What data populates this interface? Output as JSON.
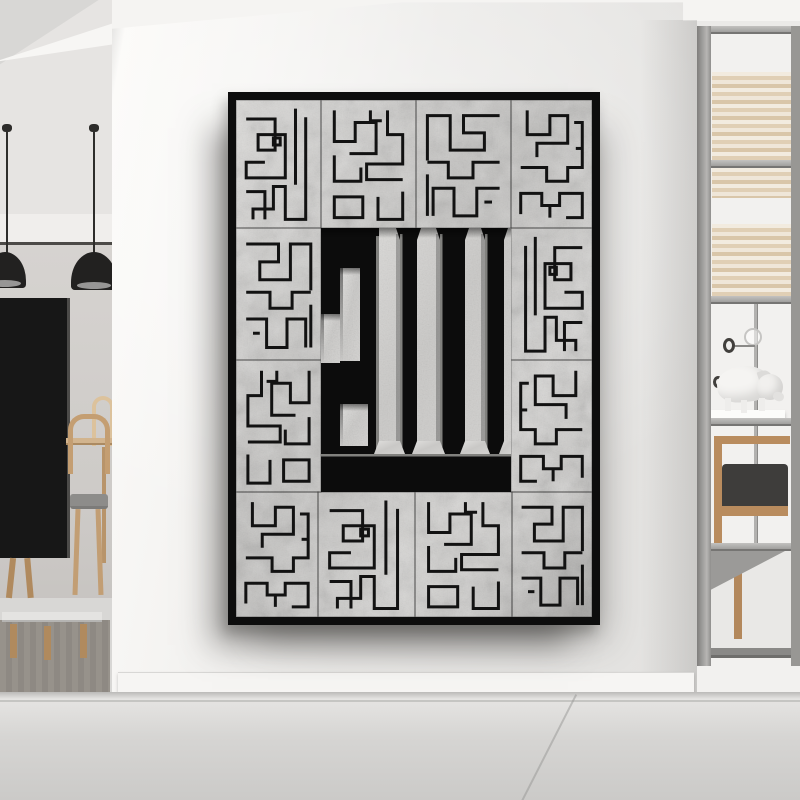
{
  "scene": {
    "subject": "Framed square Kufic calligraphy canvas hanging on a white wall in a modern minimalist interior",
    "rooms": {
      "left": [
        "pendant lamps",
        "tv panel",
        "dining table and chairs",
        "bench on rug"
      ],
      "right": [
        "metal shelving unit",
        "pig figurine",
        "lounge chair",
        "coat pole"
      ]
    }
  },
  "colors": {
    "wall_bright": "#fbfaf8",
    "wall_mid": "#ebeae8",
    "wall_shaded": "#e2e1df",
    "ceiling": "#f5f4f2",
    "room_upper_wall": "#e6e4e2",
    "room_band": "#f0eeec",
    "room_trim": "#4c4a47",
    "room_floor": "#d8d7d5",
    "rug": "#96918a",
    "lamp_black": "#222120",
    "lamp_rim": "#979695",
    "cord": "#2e2d2b",
    "tv_black": "#171717",
    "wood": "#c49e72",
    "wood_light": "#dcc29c",
    "wood_dark": "#b08a5e",
    "seat_gray": "#8d8c8a",
    "shelf_plate": "#a09f9d",
    "shelf_plate_light": "#c3c2c0",
    "shelf_back": "#f2f1ef",
    "slat_light": "#f2ebdf",
    "slat_dark": "#e0cfb5",
    "pole_gray": "#b2b1af",
    "pig_white": "#f5f4f2",
    "pig_shade": "#d8d7d5",
    "cushion_dark": "#3e3d3b",
    "chair_wood": "#b98c5e",
    "floor_light": "#e5e4e2",
    "floor_dark": "#cbcac8",
    "baseboard": "#f6f5f3",
    "frame_black": "#0d0d0d",
    "marble_light": "#d9d8d6",
    "marble_dark": "#bcbbb9",
    "ink": "#0c0c0c"
  },
  "artwork": {
    "word": "الله",
    "style": "square-kufic",
    "frame": {
      "x": 228,
      "y": 92,
      "w": 372,
      "h": 533,
      "border": 8
    },
    "inner": {
      "w": 356,
      "h": 517
    },
    "tiles": [
      {
        "x": 0,
        "y": 0,
        "w": 85,
        "h": 128,
        "p": "a"
      },
      {
        "x": 85,
        "y": 0,
        "w": 95,
        "h": 128,
        "p": "b"
      },
      {
        "x": 180,
        "y": 0,
        "w": 95,
        "h": 128,
        "p": "c",
        "fx": 1
      },
      {
        "x": 275,
        "y": 0,
        "w": 81,
        "h": 128,
        "p": "d"
      },
      {
        "x": 0,
        "y": 128,
        "w": 85,
        "h": 132,
        "p": "c"
      },
      {
        "x": 0,
        "y": 260,
        "w": 85,
        "h": 132,
        "p": "b",
        "fx": 1
      },
      {
        "x": 275,
        "y": 128,
        "w": 81,
        "h": 132,
        "p": "a",
        "fx": 1
      },
      {
        "x": 275,
        "y": 260,
        "w": 81,
        "h": 132,
        "p": "d",
        "fx": 1
      },
      {
        "x": 0,
        "y": 392,
        "w": 82,
        "h": 125,
        "p": "d"
      },
      {
        "x": 82,
        "y": 392,
        "w": 97,
        "h": 125,
        "p": "a"
      },
      {
        "x": 179,
        "y": 392,
        "w": 97,
        "h": 125,
        "p": "b"
      },
      {
        "x": 276,
        "y": 392,
        "w": 80,
        "h": 125,
        "p": "c"
      }
    ],
    "patterns": {
      "a": [
        "M70 10 V98",
        "M82 20 V138 H58 V100 H44 V126 H20 V138",
        "M12 22 H46 V58 H26 V40 H58 V90 H12 V72 H34",
        "M12 106 H34 V138",
        "M44 44 H52 V52 H44 Z"
      ],
      "b": [
        "M14 12 V48 H36 V26 H58 V62 H30",
        "M70 12 V40 H86 V74 H48 V92 H86",
        "M14 64 V94 H42 V78",
        "M14 112 H44 V136 H14 Z",
        "M60 112 V138 H86 V106",
        "M64 24 H52 V12"
      ],
      "c": [
        "M12 18 H50 V38 H28 V58 H64 V18 H88 V70",
        "M12 72 H40 V90 H66 V72 H88",
        "M12 102 H36 V134 H60 V102 H82 V134",
        "M88 86 V134",
        "M20 118 H28"
      ],
      "d": [
        "M20 12 V40 H48 V18 H70 V50 H32 V66",
        "M12 78 H44 V94 H70 V78 H88 V26 H78",
        "M12 132 V108 H38 V122 H60 V108 H88 V136 H68",
        "M48 136 V122",
        "M80 56 H88"
      ]
    },
    "glyph": {
      "region": {
        "x": 85,
        "y": 128,
        "w": 190,
        "h": 264
      },
      "black": [
        [
          0,
          0,
          58,
          226
        ],
        [
          79,
          0,
          17,
          226
        ],
        [
          119,
          0,
          25,
          226
        ],
        [
          164,
          0,
          19,
          226
        ],
        [
          0,
          226,
          190,
          38
        ]
      ],
      "caps": [
        "75,0 100,0 96,12 79,12",
        "115,0 148,0 144,12 119,12",
        "160,0 187,0 183,12 164,12"
      ],
      "marble": [
        [
          19,
          40,
          20,
          93
        ],
        [
          0,
          86,
          19,
          49
        ],
        [
          19,
          176,
          28,
          42
        ]
      ],
      "flares": [
        "58,213 79,213 84,226 53,226",
        "96,213 119,213 124,226 91,226",
        "144,213 164,213 169,226 139,226",
        "183,213 190,213 190,226 178,226"
      ]
    }
  }
}
